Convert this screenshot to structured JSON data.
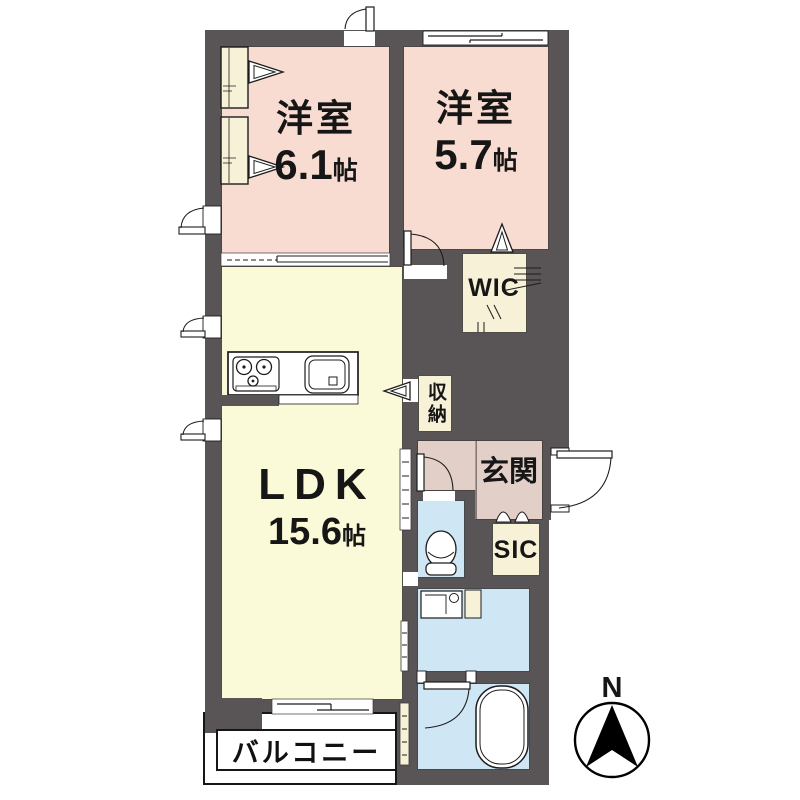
{
  "floor_plan": {
    "rooms": {
      "bedroom_1": {
        "name": "洋室",
        "size": "6.1",
        "size_unit": "帖"
      },
      "bedroom_2": {
        "name": "洋室",
        "size": "5.7",
        "size_unit": "帖"
      },
      "ldk": {
        "name": "LDK",
        "size": "15.6",
        "size_unit": "帖"
      },
      "wic": {
        "name": "WIC"
      },
      "storage": {
        "name": "収納"
      },
      "entrance": {
        "name": "玄関"
      },
      "shoe_closet": {
        "name": "SIC"
      },
      "balcony": {
        "name": "バルコニー"
      }
    },
    "compass": {
      "north_label": "N"
    },
    "colors": {
      "wall": "#595557",
      "bedroom": "#f9dcd1",
      "ldk": "#fafad8",
      "closet": "#f7f2d7",
      "entrance": "#e2cfc8",
      "wet": "#cfe6f5",
      "paper": "#ffffff",
      "line": "#1c1c1c"
    },
    "icons": [
      "compass-north-arrow-icon",
      "toilet-icon",
      "bathtub-icon",
      "stove-icon",
      "kitchen-sink-icon",
      "washing-machine-pan-icon",
      "door-swing-icon",
      "sliding-door-icon",
      "folding-door-icon",
      "casement-window-icon",
      "closet-shelf-icon"
    ]
  }
}
